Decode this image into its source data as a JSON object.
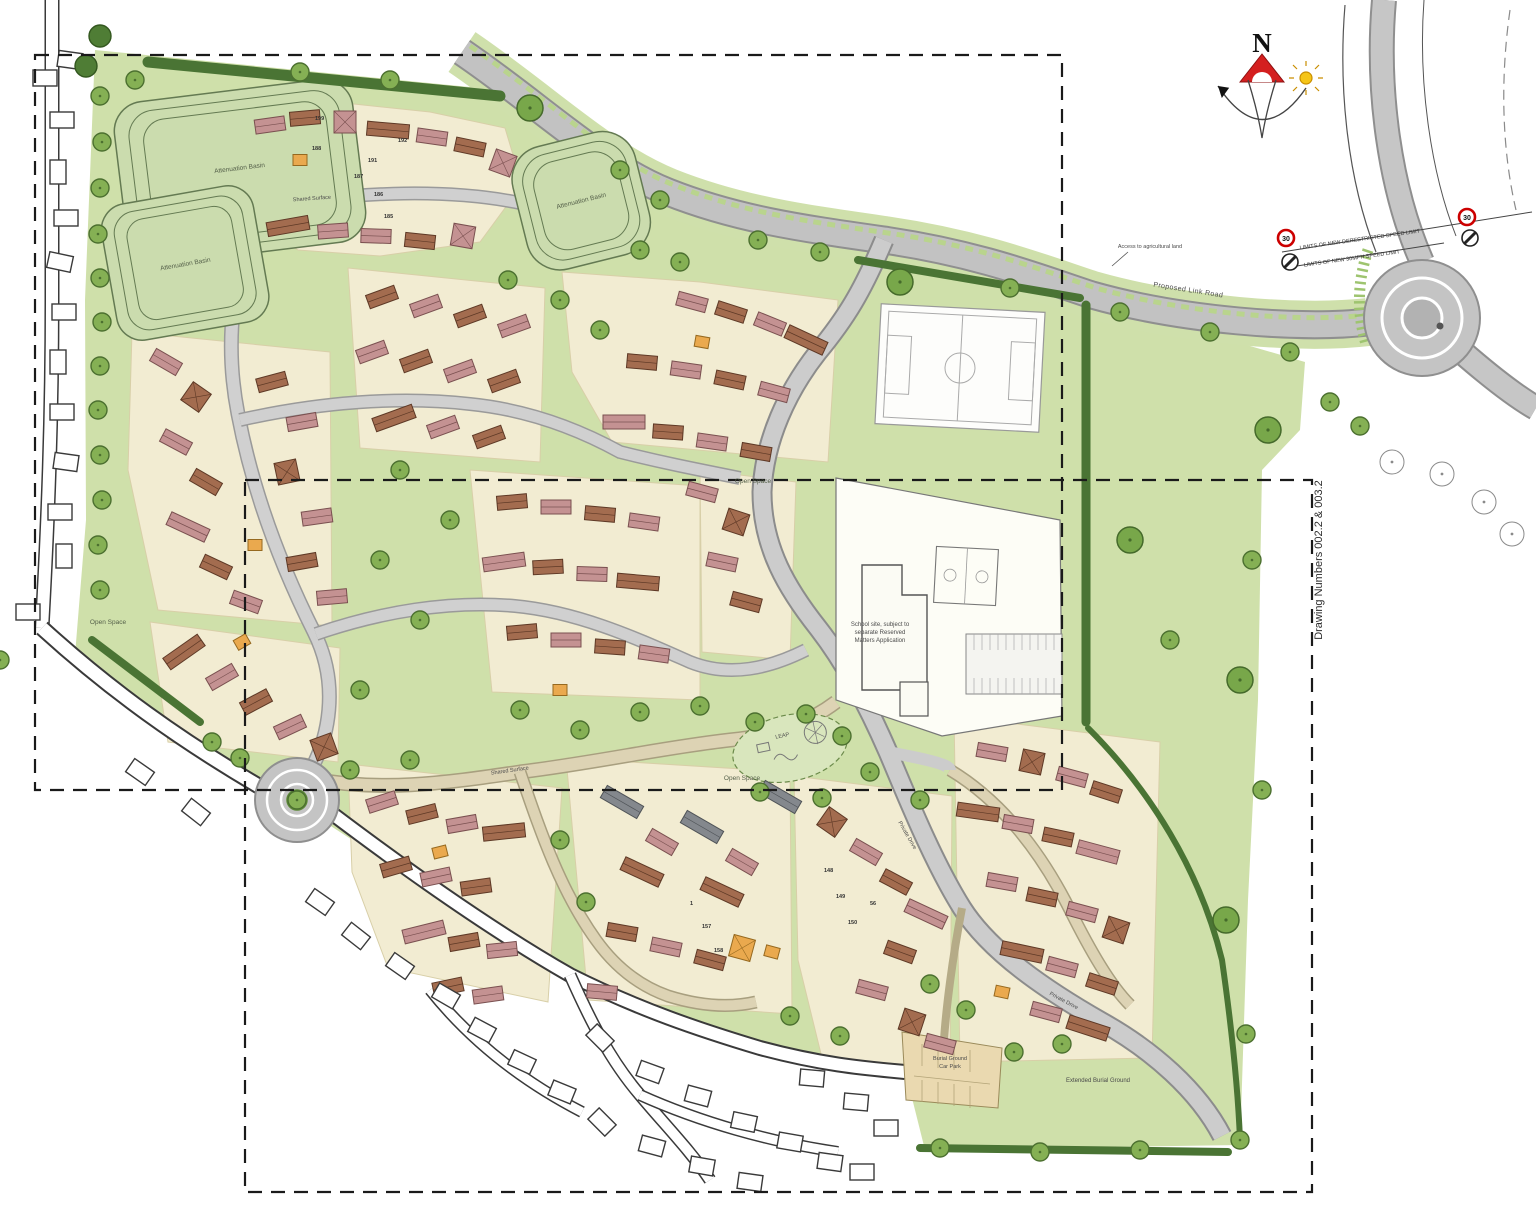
{
  "drawing": {
    "reference_note": "Drawing Numbers 002.2 & 003.2",
    "compass_north": "N"
  },
  "labels": {
    "attenuation_basin": "Attenuation Basin",
    "open_space": "Open Space",
    "school_note_line1": "School site, subject to",
    "school_note_line2": "separate Reserved",
    "school_note_line3": "Matters Application",
    "burial_car_park_line1": "Burial Ground",
    "burial_car_park_line2": "Car Park",
    "extended_burial_ground": "Extended Burial Ground",
    "access_agricultural": "Access to agricultural land",
    "road_name": "Proposed Link Road",
    "speed_limit_derestricted": "LIMITS OF NEW DERESTRICTED SPEED LIMIT",
    "speed_limit_30mph": "LIMITS OF NEW 30MPH SPEED LIMIT",
    "leap": "LEAP",
    "shared_surface": "Shared Surface",
    "private_drive": "Private Drive",
    "sign_30": "30"
  },
  "plots": [
    "199",
    "188",
    "191",
    "187",
    "186",
    "185",
    "192",
    "148",
    "149",
    "150",
    "156",
    "157",
    "158"
  ],
  "colors": {
    "site_green": "#cfe0aa",
    "parcel_cream": "#f2ecd2",
    "road_grey": "#c9c9c9",
    "hedge_green": "#4a7434",
    "tree_green": "#85b054",
    "basin_green": "#cbdcae",
    "house_rose": "#c49292",
    "house_brown": "#a36c4f",
    "house_orange": "#eaa94e",
    "house_grey": "#84888d",
    "speed_sign_red": "#cc0000",
    "compass_red": "#d41f1f",
    "sun_yellow": "#f5c518"
  }
}
